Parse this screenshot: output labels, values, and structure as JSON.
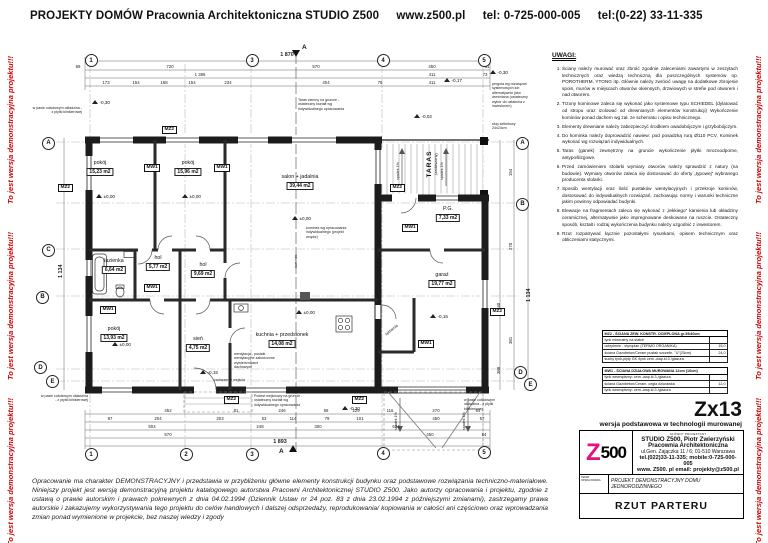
{
  "header": {
    "title": "PROJEKTY DOMÓW Pracownia Architektoniczna STUDIO Z500",
    "url": "www.z500.pl",
    "phone1": "tel: 0-725-000-005",
    "phone2": "tel:(0-22) 33-11-335"
  },
  "watermark": {
    "text": "To jest wersja demonstracyjna projektu!!!",
    "color": "#cc0000"
  },
  "plan": {
    "rooms": [
      {
        "name": "pokój",
        "area": "15,23 m2"
      },
      {
        "name": "pokój",
        "area": "15,96 m2"
      },
      {
        "name": "salon + jadalnia",
        "area": "39,44 m2"
      },
      {
        "name": "TARAS",
        "sub": "(zadaszony)"
      },
      {
        "name": "P.G.",
        "area": "7,33 m2"
      },
      {
        "name": "łazienka",
        "area": "6,64 m2"
      },
      {
        "name": "hol",
        "area": "5,77 m2"
      },
      {
        "name": "hol",
        "area": "9,69 m2"
      },
      {
        "name": "pokój",
        "area": "13,93 m2"
      },
      {
        "name": "sień",
        "area": "4,75 m2"
      },
      {
        "name": "kuchnia + przedsionek",
        "area": "14,08 m2"
      },
      {
        "name": "garaż",
        "area": "19,77 m2"
      },
      {
        "name": "spiżarnia"
      }
    ],
    "wall_tags": {
      "mz2": "MZ2",
      "mw1": "MW1"
    },
    "elevations": {
      "zero": "±0,00",
      "m30": "-0,30",
      "m17": "-0,17",
      "m02": "-0,02",
      "m15": "-0,15"
    },
    "grid": {
      "top": [
        "1",
        "3",
        "4",
        "5"
      ],
      "bottom": [
        "1",
        "2",
        "3",
        "4",
        "5"
      ],
      "left": [
        "A",
        "C",
        "B",
        "D",
        "E"
      ],
      "right": [
        "A",
        "B",
        "D",
        "E"
      ]
    },
    "dims": {
      "top_total": "1 870",
      "top_row1": [
        "69",
        "720",
        "570",
        "450",
        "61"
      ],
      "top_row2": [
        "1 386",
        "411",
        "73"
      ],
      "top_row3": [
        "173",
        "154",
        "168",
        "154",
        "234",
        "404",
        "76",
        "411"
      ],
      "bottom_row1": [
        "452",
        "81",
        "246",
        "58",
        "129",
        "116",
        "270",
        "64"
      ],
      "bottom_row2": [
        "97",
        "204",
        "203",
        "53",
        "114",
        "79",
        "101",
        "450",
        "57"
      ],
      "bottom_row3": [
        "504",
        "248",
        "300",
        "634"
      ],
      "bottom_row4": [
        "570",
        "450",
        "84"
      ],
      "bottom_total": "1 893",
      "left_total": "1 134",
      "right_total": "1 134",
      "right_col": [
        "154",
        "270",
        "840",
        "381",
        "388"
      ]
    },
    "annotations": {
      "cokol": "w pasie cokołowym okładzina - z płytki klinkierowej",
      "taras_ziemny": "Taras ziemny na gruncie - ostateczny kształt wg indywidualnego opracowania",
      "pergola": "pergola wg rozwiązań systemowych lub alternatywnie jako drewniana (ostateczny wybór do ustalenia z inwestorem)",
      "slup": "słup żelbetowy 24x24cm",
      "zadaszenie": "zadaszenie wejścia",
      "podest": "Podest wejściowy na gruncie - ostateczny kształt wg indywidualnego opracowania",
      "kominek": "kominek",
      "spadek": "spadek 1%",
      "kominek_note": "kominek wg opracowania indywidualnego (projekt wnętrz)",
      "went_note": "wentylacja - pustaki wentylacyjne zakończone wywietrznikami dachowymi",
      "section": "A"
    }
  },
  "notes": {
    "heading": "UWAGI:",
    "items": [
      "Ściany należy murować oraz zbroić zgodnie zaleceniami zawartymi w zeszytach technicznych oraz wiedzą techniczną dla poszczególnych systemów np. POROTHERM, YTONG itp. Głównie należy zwrócić uwagę na dodatkowe zbrojenie spoin, murów w miejscach otworów okiennych, drzwiowych w strefie pod otworem i nad otworem.",
      "Trzony kominowe zaleca się wykonać jako systemowe typu SCHIEDEL (dylatować od stropu oraz izolować od drewnianych elementów konstrukcji) Wykończenie kominów ponad dachem wg zał. ze schematu i opisu technicznego.",
      "Elementy drewniane należy zabezpieczyć środkiem owadobójczym i grzybobójczym.",
      "Do kominka należy doprowadzić nawiew: pod posadzką rurą Ø110 PCV, Kominek wykonać wg rozwiązań indywidualnych.",
      "Taras (ganek) zewnętrzny na gruncie wykończenie płytki mrozoodporne, antypoślizgowe.",
      "Przed zamówieniem stolarki wymiary otworów należy sprawdzić z natury (na budowie). Wymiary otworów zaleca się dostosować do oferty „typowej” wybranego producenta stolarki.",
      "Sposób wentylacji oraz ilość pustaków wentylacyjnych i przekroje kominów, dostosować do indywidualnych rozwiązań, zachowując normy i warunki techniczne jakim powinny odpowiadać budynki.",
      "Elewacje na fragmentach zaleca się wykonać z „lekkiego” kamienia lub okładziny ceramicznej, alternatywnie jako impregnowane deskowane na ruszcie. Ostateczny sposób, kształt i rodzaj wykończenia budynku należy uzgodnić z inwestorem.",
      "Rzut rozpatrywać łącznie pozostałymi rysunkami, opisem technicznym oraz obliczeniami statycznymi."
    ]
  },
  "legend": {
    "tables": [
      {
        "title": "MZ2 - ŚCIANA ZEW. KONSTR. OCIEPLONA gr.39/40cm",
        "rows": [
          {
            "label": "tynk mineralny na siatce",
            "value": ""
          },
          {
            "label": "ocieplenie - styropian (TERMO ORGANIKA)",
            "value": "15,0"
          },
          {
            "label": "ściana Gazobeton/Ceram pustak szczelin. \"U\"(25cm)",
            "value": "24,0"
          },
          {
            "label": "suchy tynk-płyty GK /tynk cem.-wap.kl.3 /glazura",
            "value": ""
          }
        ]
      },
      {
        "title": "MW1 - ŚCIANA DZIAŁOWA MUROWANA 12cm (16cm)",
        "rows": [
          {
            "label": "tynk wewnętrzny: cem.-wap.kl.3 /glazura",
            "value": ""
          },
          {
            "label": "ściana Gazobeton/Ceram. cegła dziurawka",
            "value": "12,0"
          },
          {
            "label": "tynk wewnętrzny: cem.-wap.kl.3 /glazura",
            "value": ""
          }
        ]
      }
    ]
  },
  "titleblock": {
    "code": "Zx13",
    "subtitle": "wersja podstawowa w technologii murowanej",
    "logo_z": "Z",
    "logo_500": "500",
    "role_label": "GŁÓWNY PROJEKTANT",
    "studio": "STUDIO Z500, Piotr Zwierzyński",
    "studio2": "Pracownia Architektoniczna",
    "address": "ul.Gen. Zajączka 11 / 6; 01-510 Warszawa",
    "phones": "tel.(022)33-11-335; mobile:0-725-000-005",
    "web": "www. Z500. pl   email: projekty@z500.pl",
    "subject_label": "TEMAT OPRACOWANIA",
    "subject": "PROJEKT DEMONSTRACYJNY DOMU JEDNORODZINNEGO",
    "drawing_title": "RZUT PARTERU"
  },
  "disclaimer": "Opracowanie ma charakter DEMONSTRACYJNY i przedstawia w przybliżeniu główne elementy konstrukcji budynku oraz podstawowe rozwiązania techniczno-materiałowe. Niniejszy projekt jest wersją demonstracyjną projektu katalogowego autorstwa Pracowni Architektonicznej STUDIO Z500. Jako autorzy opracowania i projektu, zgodnie z ustawą o prawie autorskim i prawach pokrewnych z dnia 04.02.1994 (Dziennik Ustaw nr 24 poz. 83 z dnia 23.02.1994 z późniejszymi zmianami), zastrzegamy prawa autorskie i zakazujemy wykorzystywania tego projektu do celów handlowych i dalszej odsprzedaży, reprodukowania/ kopiowania w całości ani częściowo oraz wprowadzania zmian ponad wymienione w projekcie, bez naszej wiedzy i zgody"
}
